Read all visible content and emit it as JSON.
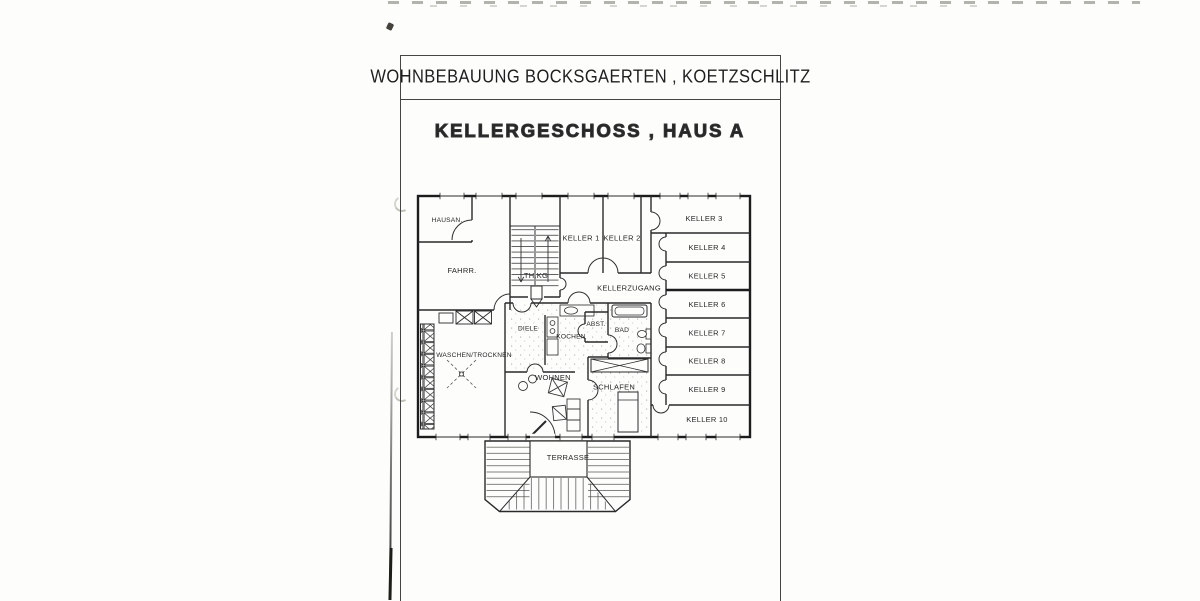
{
  "document": {
    "title": "WOHNBEBAUUNG BOCKSGAERTEN , KOETZSCHLITZ",
    "subtitle": "KELLERGESCHOSS , HAUS A"
  },
  "rooms": {
    "hausan": "HAUSAN.",
    "fahrr": "FAHRR.",
    "th_kg": "TH.KG",
    "keller1": "KELLER 1",
    "keller2": "KELLER 2",
    "kellerzugang": "KELLERZUGANG",
    "diele": "DIELE",
    "kochen": "KOCHEN",
    "abst": "ABST.",
    "bad": "BAD",
    "waschen_trocknen": "WASCHEN/TROCKNEN",
    "wohnen": "WOHNEN",
    "schlafen": "SCHLAFEN",
    "terrasse": "TERRASSE"
  },
  "keller_units": [
    "KELLER 3",
    "KELLER 4",
    "KELLER 5",
    "KELLER 6",
    "KELLER 7",
    "KELLER 8",
    "KELLER 9",
    "KELLER 10"
  ],
  "colors": {
    "ink": "#2a2a2a",
    "paper": "#fdfdfc"
  }
}
